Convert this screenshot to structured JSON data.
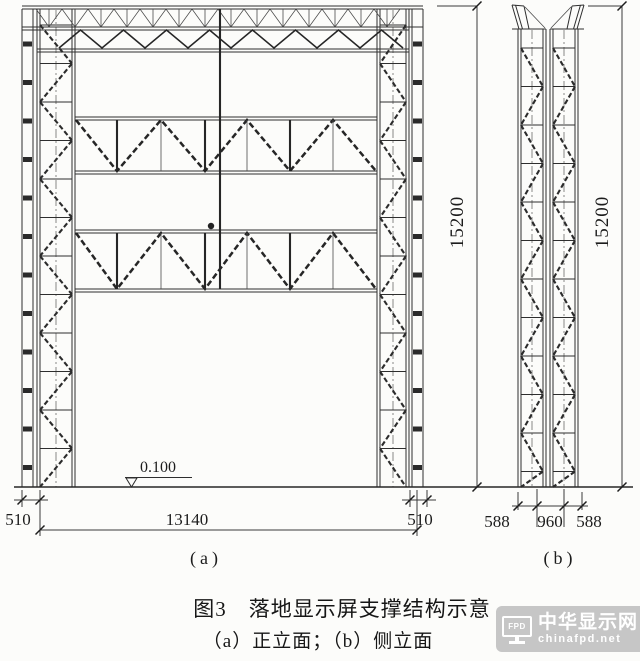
{
  "figure": {
    "caption_line1": "图3　落地显示屏支撑结构示意",
    "caption_line2": "（a）正立面；（b）侧立面"
  },
  "front_elevation": {
    "label": "(a)",
    "level_mark": "0.100",
    "dim_height": "15200",
    "dim_left": "510",
    "dim_span": "13140",
    "dim_right": "510"
  },
  "side_elevation": {
    "label": "(b)",
    "dim_height": "15200",
    "dim_left": "588",
    "dim_mid": "960",
    "dim_right": "588"
  },
  "watermark": {
    "icon_label": "FPD",
    "site_name": "中华显示网",
    "site_url": "chinafpd.net",
    "bg_color": "#c6c6c6",
    "text_color": "#ffffff"
  },
  "colors": {
    "line": "#2e2e2e",
    "paper": "#fcfcfa"
  }
}
